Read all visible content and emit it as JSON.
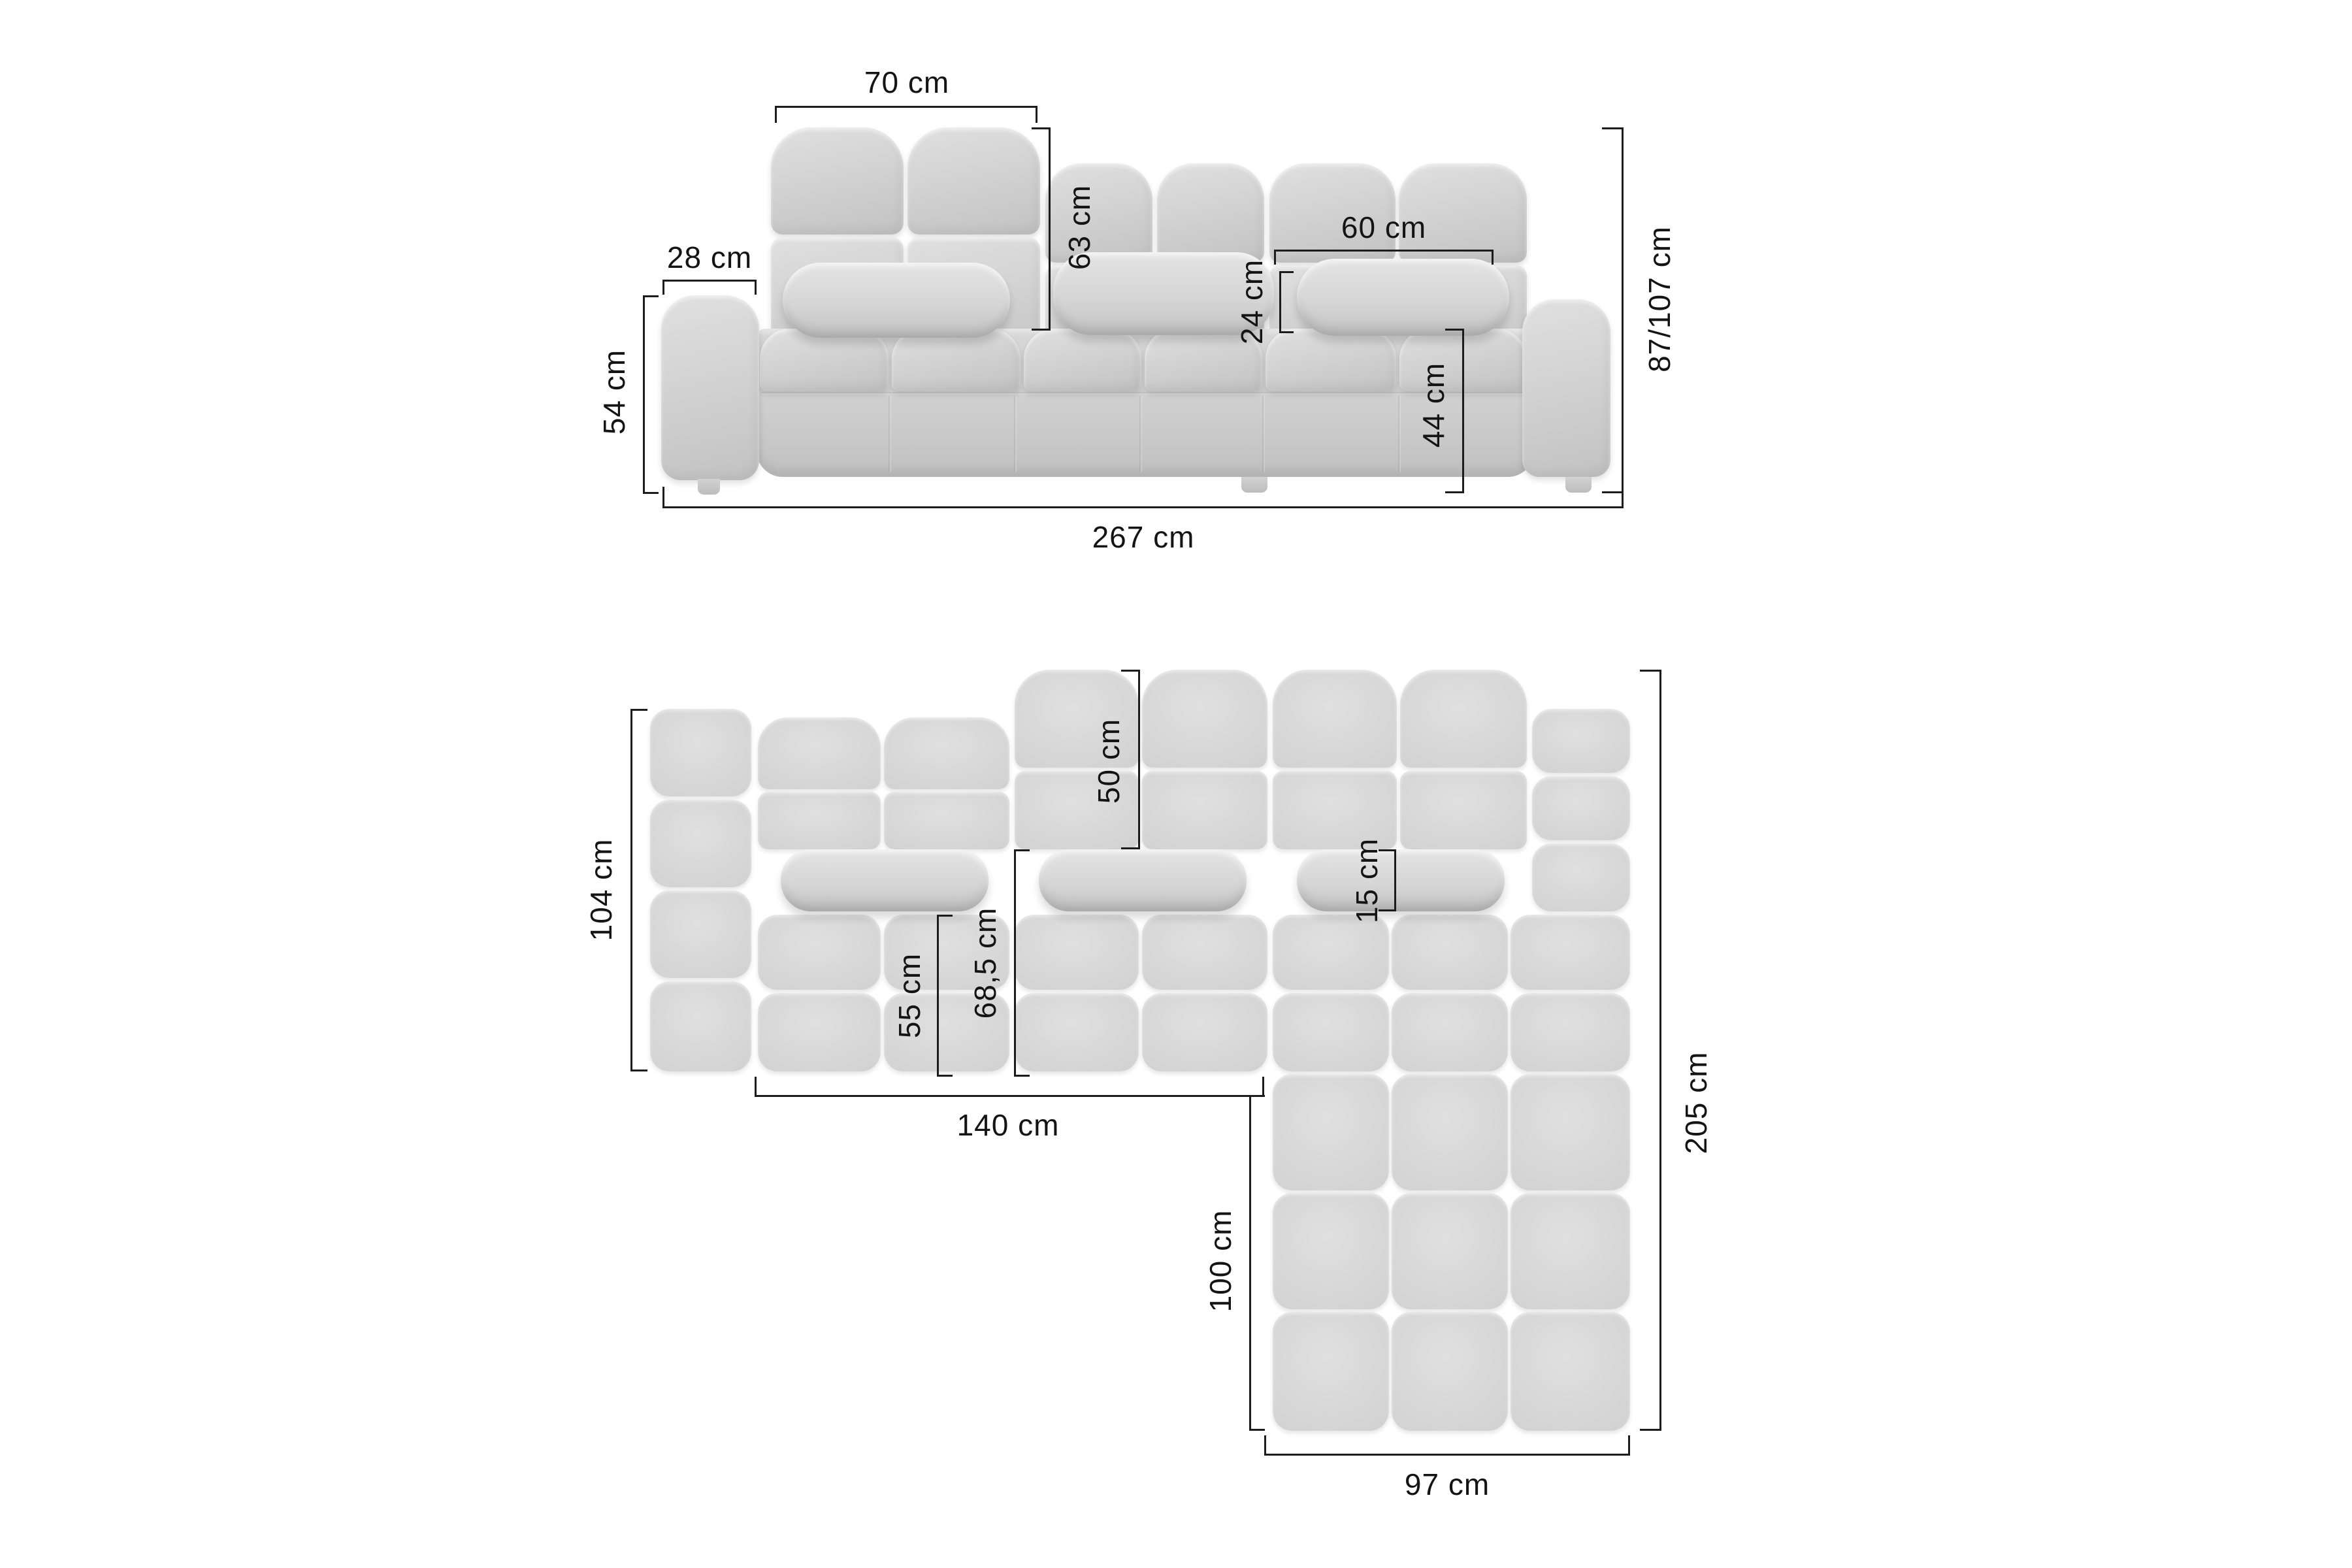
{
  "diagram_title": "corner-sofa-dimension-diagram",
  "colors": {
    "background": "#ffffff",
    "dimension_line": "#1c1c1c",
    "sofa_base": "#cdcdcd",
    "sofa_highlight": "#e2e2e2",
    "sofa_shadow": "#b8b8b8"
  },
  "front_view": {
    "name": "sofa front view",
    "dimensions": {
      "backrest_width": "70 cm",
      "backrest_height": "63 cm",
      "armrest_width": "28 cm",
      "armrest_height": "54 cm",
      "pillow_width": "60 cm",
      "pillow_height": "24 cm",
      "seat_height": "44 cm",
      "total_height": "87/107 cm",
      "total_width": "267 cm"
    }
  },
  "top_view": {
    "name": "sofa top view",
    "dimensions": {
      "main_depth": "104 cm",
      "backrest_depth": "50 cm",
      "pillow_depth": "15 cm",
      "seat_depth": "55 cm",
      "seat_with_pillow_depth": "68,5 cm",
      "main_section_width": "140 cm",
      "chaise_extension_length": "100 cm",
      "total_depth": "205 cm",
      "chaise_width": "97 cm"
    }
  }
}
